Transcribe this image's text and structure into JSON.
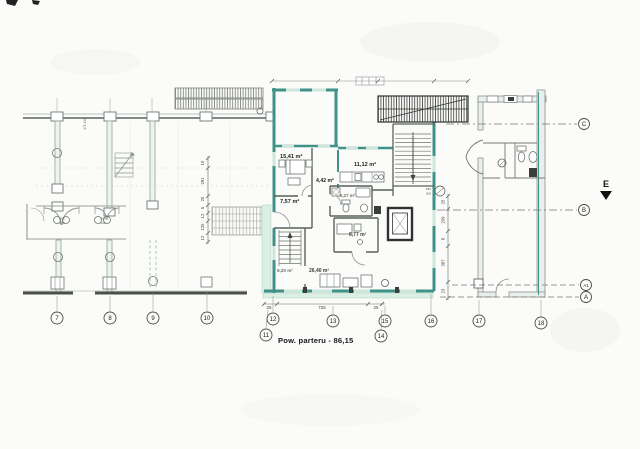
{
  "drawing": {
    "caption": "Pow. parteru - 86,15",
    "direction_label": "E",
    "rooms": {
      "r1": "15,41 m²",
      "r2": "11,12 m²",
      "r3": "4,42 m²",
      "r4": "7,57 m²",
      "r5": "5,27 m²",
      "r6": "6,77 m²",
      "r7": "9,20 m²",
      "r8": "26,40 m²"
    },
    "axes": {
      "bottom": [
        "7",
        "8",
        "9",
        "10",
        "11",
        "12",
        "13",
        "14",
        "15",
        "16",
        "17",
        "18"
      ],
      "right": [
        "C",
        "B",
        "A1",
        "A"
      ]
    },
    "dims": {
      "bottom": [
        "25",
        "725",
        "25"
      ],
      "mid": [
        "10",
        "291",
        "25",
        "5",
        "12",
        "125",
        "12"
      ],
      "right": [
        "25",
        "209",
        "8",
        "387",
        "23"
      ],
      "small_left": "171 440",
      "door_width": "206",
      "door_height": "240",
      "tag_180": "180",
      "tag_206": "206"
    },
    "colors": {
      "wall_teal": "#3f9287",
      "window_teal": "#cde7dc",
      "paving_green": "#dcefe4",
      "line_gray": "#99a39c",
      "line_dark": "#3a3f3c"
    }
  }
}
